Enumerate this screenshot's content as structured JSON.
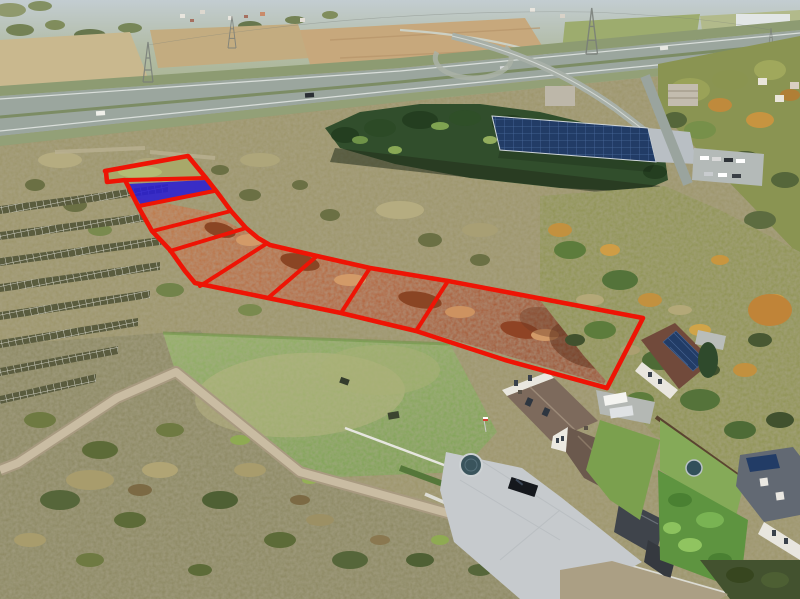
{
  "image": {
    "kind": "aerial-drone-photograph",
    "subject": "Aerial view of suburban land for sale: a chain of nine building plots outlined in red runs diagonally across autumn scrubland, with one plot highlighted solid blue; a highway with interchange, a solar-roofed warehouse and evergreen forest sit behind, detached houses with gardens in the foreground.",
    "visible_text_present": false,
    "width_px": 800,
    "height_px": 599
  },
  "overlay": {
    "plot_count": 9,
    "outline_color": "#ee1405",
    "outline_width": 4.6,
    "divider_width": 4,
    "highlight_fill": "#2a1ed2",
    "highlight_opacity": 0.88,
    "boundary_points": "105,171 188,156 206,178 217,192 231,211 246,228 258,238 270,245 317,256 370,268 448,281 643,318 607,388 505,360 416,331 341,313 268,298 195,283 185,271 170,250 152,231 139,208 125,180 107,182 106,172",
    "highlight_points": "128,184 206,180 214,191 140,204",
    "dividers": [
      "125,180 206,178",
      "139,206 214,191",
      "153,231 231,211",
      "170,251 246,228",
      "266,244 200,286",
      "317,256 268,298",
      "370,268 341,313",
      "448,281 416,331"
    ]
  },
  "palette": {
    "haze": "#bdc9cd",
    "distant-field": "#c9b88e",
    "plowed-field": "#c7a87c",
    "green-field": "#9dac6e",
    "highway": "#9ba69e",
    "verge": "#8d9b72",
    "forest-dark": "#314e2c",
    "forest-mid": "#4e7340",
    "autumn-olive": "#8f9a52",
    "autumn-orange": "#c08a3e",
    "scrub": "#9c9468",
    "scrub-dark": "#6f7348",
    "rust-light": "#c97d48",
    "rust-dark": "#a0522d",
    "lawn": "#8aac5c",
    "lawn-light": "#aeb37d",
    "dirt-road": "#c2b59c",
    "paver": "#c6cacd",
    "roof-brown": "#7d6a5c",
    "roof-dark": "#474c52",
    "wall-white": "#eceae2",
    "solar-panel": "#223c66",
    "garden-green": "#5f9a40",
    "fence-brown": "#5a4430"
  }
}
